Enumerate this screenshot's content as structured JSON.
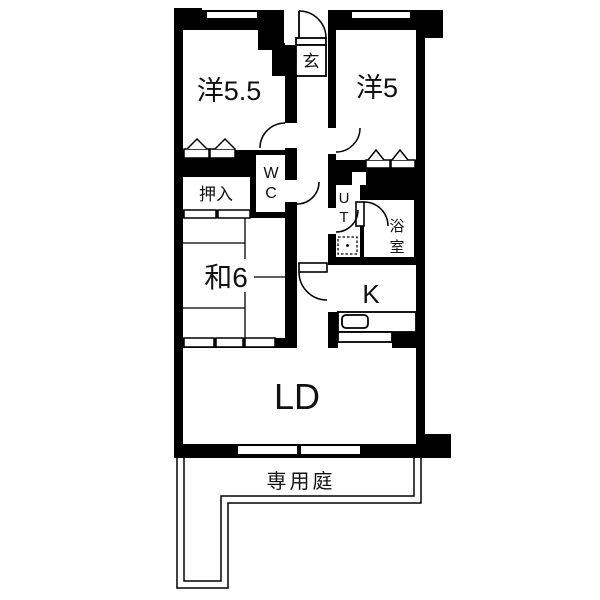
{
  "plan": {
    "type": "apartment-floor-plan",
    "rooms": {
      "western_55": {
        "label": "洋5.5"
      },
      "western_5": {
        "label": "洋5"
      },
      "entrance": {
        "label": "玄"
      },
      "wc": {
        "char1": "W",
        "char2": "C"
      },
      "oshiire": {
        "label": "押入"
      },
      "utility": {
        "char1": "U",
        "char2": "T"
      },
      "bath": {
        "char1": "浴",
        "char2": "室"
      },
      "japanese_6": {
        "label": "和6"
      },
      "kitchen": {
        "label": "K"
      },
      "living_dining": {
        "label": "LD"
      }
    },
    "outdoor": {
      "private_garden": {
        "label": "専用庭"
      }
    },
    "colors": {
      "wall": "#000000",
      "floor": "#ffffff",
      "line": "#000000"
    }
  }
}
